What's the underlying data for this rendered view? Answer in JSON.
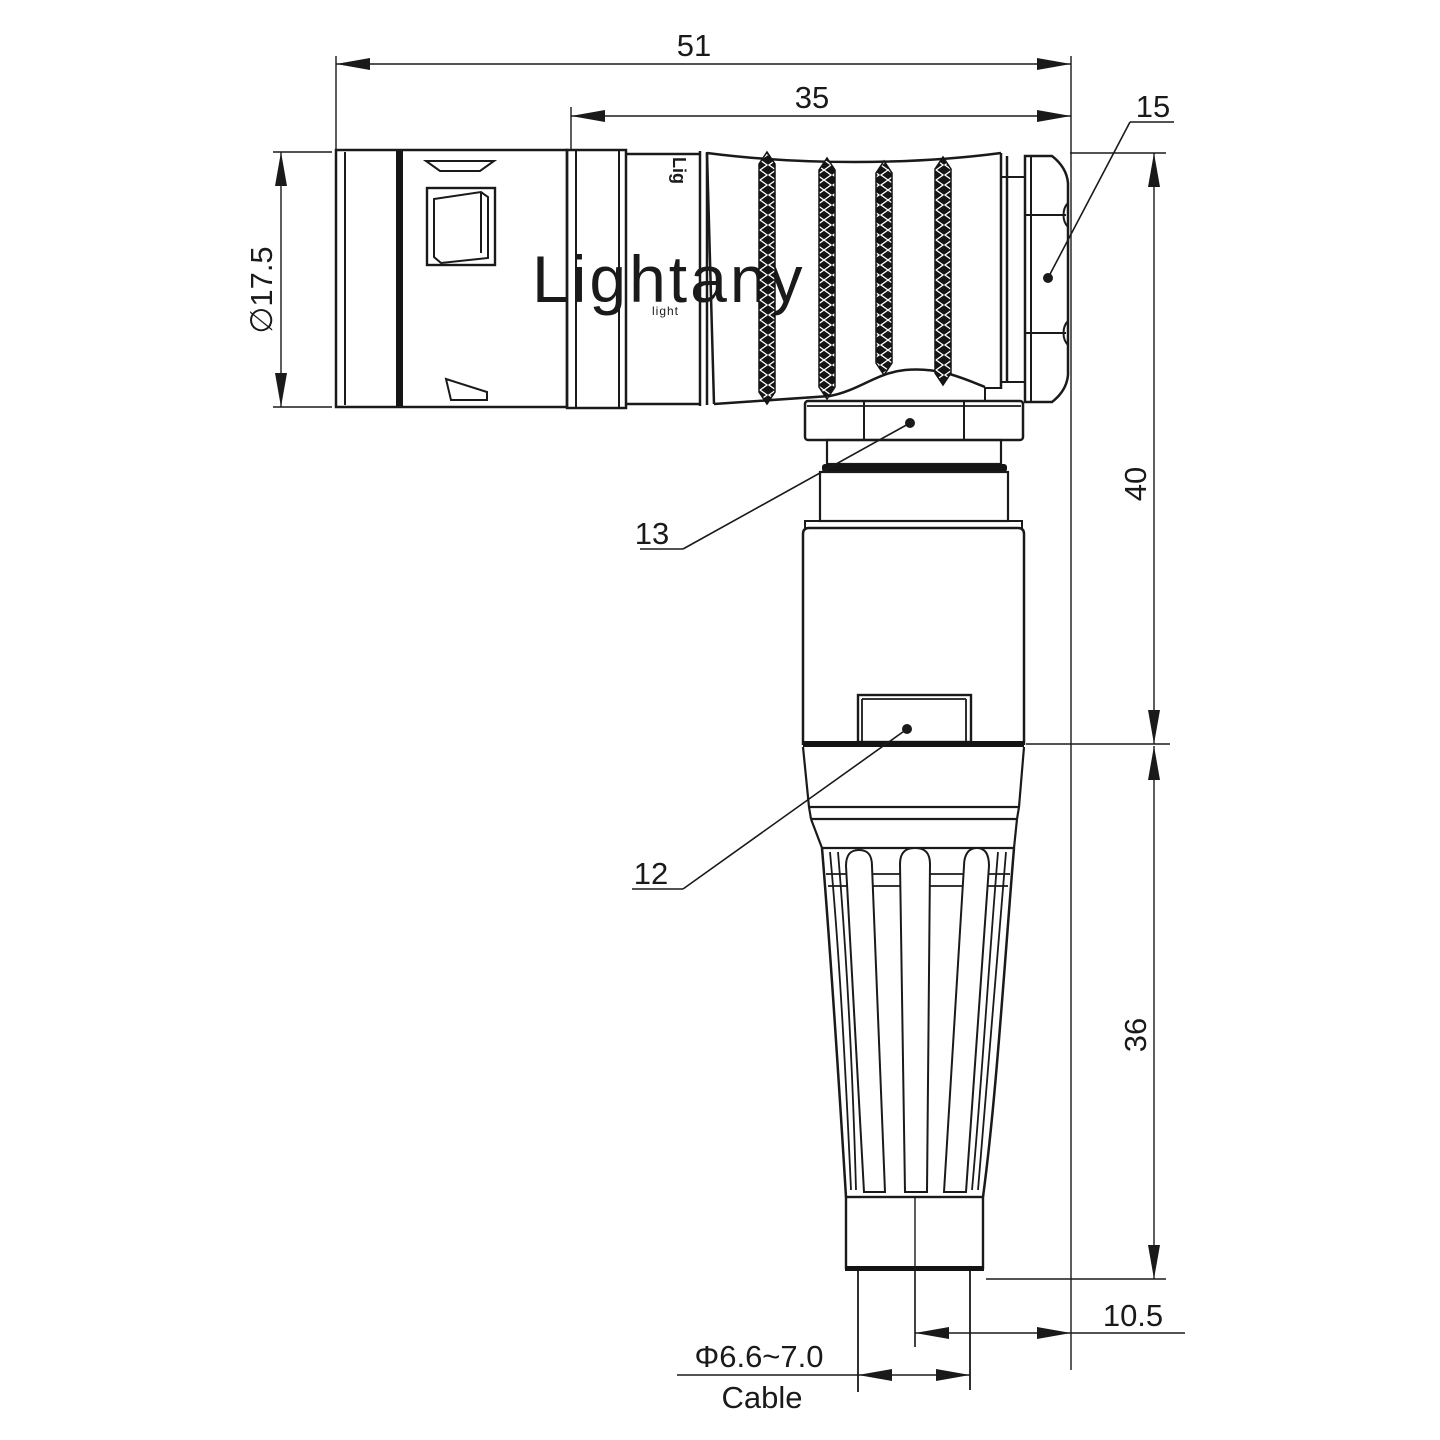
{
  "title": "Right-angle connector technical drawing",
  "watermark": {
    "text": "Lightany",
    "subtext": "light",
    "color": "#efbcbc"
  },
  "engraving": "Lig",
  "dims": {
    "overall_length": "51",
    "boot_length": "35",
    "plug_dia": "∅17.5",
    "height_upper": "40",
    "height_lower": "36",
    "axis_offset": "10.5",
    "cable_dia": "Φ6.6~7.0",
    "cable_label": "Cable"
  },
  "callouts": {
    "hex_nut": "15",
    "coupling_nut": "13",
    "latch": "12"
  },
  "colors": {
    "line": "#1a1a1a",
    "background": "#ffffff",
    "watermark": "#efbcbc"
  }
}
